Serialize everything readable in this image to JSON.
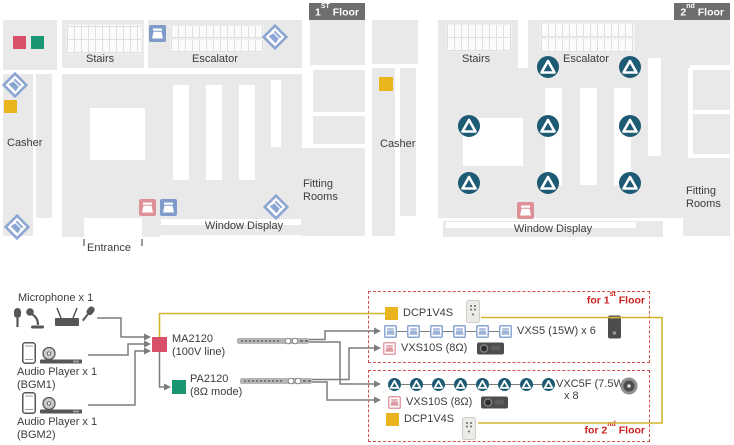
{
  "floors": {
    "floor1": {
      "badge": {
        "num": "1",
        "sup": "ST",
        "word": " Floor"
      },
      "areas": {
        "stairs": "Stairs",
        "escalator": "Escalator",
        "casher": "Casher",
        "fitting_rooms": "Fitting Rooms",
        "window_display": "Window Display",
        "entrance": "Entrance"
      }
    },
    "floor2": {
      "badge": {
        "num": "2",
        "sup": "nd",
        "word": " Floor"
      },
      "areas": {
        "stairs": "Stairs",
        "escalator": "Escalator",
        "casher": "Casher",
        "fitting_rooms": "Fitting Rooms",
        "window_display": "Window Display"
      }
    }
  },
  "system": {
    "sources": {
      "microphone": {
        "label": "Microphone x 1"
      },
      "audio_player1": {
        "label": "Audio Player x 1",
        "sub": "(BGM1)"
      },
      "audio_player2": {
        "label": "Audio Player x 1",
        "sub": "(BGM2)"
      }
    },
    "amps": {
      "ma2120": {
        "name": "MA2120",
        "mode": "(100V line)"
      },
      "pa2120": {
        "name": "PA2120",
        "mode": "(8Ω mode)"
      }
    },
    "group1": {
      "tag": {
        "prefix": "for 1",
        "sup": "st",
        "suffix": " Floor"
      },
      "dcp_label": "DCP1V4S",
      "vxs5": {
        "label": "VXS5 (15W) x 6",
        "count": 6
      },
      "vxs10s_label": "VXS10S (8Ω)"
    },
    "group2": {
      "tag": {
        "prefix": "for 2",
        "sup": "nd",
        "suffix": " Floor"
      },
      "dcp_label": "DCP1V4S",
      "vxc5f": {
        "label": "VXC5F (7.5W)",
        "count_label": "x 8",
        "count": 8
      },
      "vxs10s_label": "VXS10S (8Ω)"
    }
  },
  "icons": {
    "vxs5_wall_speaker": "blue square speaker icon",
    "vxs5_surface_speaker": "blue diamond speaker icon",
    "vxc5f_ceiling_speaker": "teal circle ceiling speaker icon",
    "vxs10s_subwoofer": "red square subwoofer icon",
    "dcp1v4s_panel": "yellow square wall controller",
    "ma2120_amp": "red square amplifier marker",
    "pa2120_amp": "green square amplifier marker"
  },
  "colors": {
    "ma2120_red": "#d8506a",
    "pa2120_green": "#1b9672",
    "dcp1v4s_yellow": "#eab41e",
    "vxs5_blue": "#7f9bc9",
    "vxc5f_teal": "#1d5a73",
    "vxs10s_red": "#dd9196",
    "group_border_red": "#d05050",
    "control_line_yellow": "#d2b52e",
    "floor_gray": "#e9e9e9"
  }
}
